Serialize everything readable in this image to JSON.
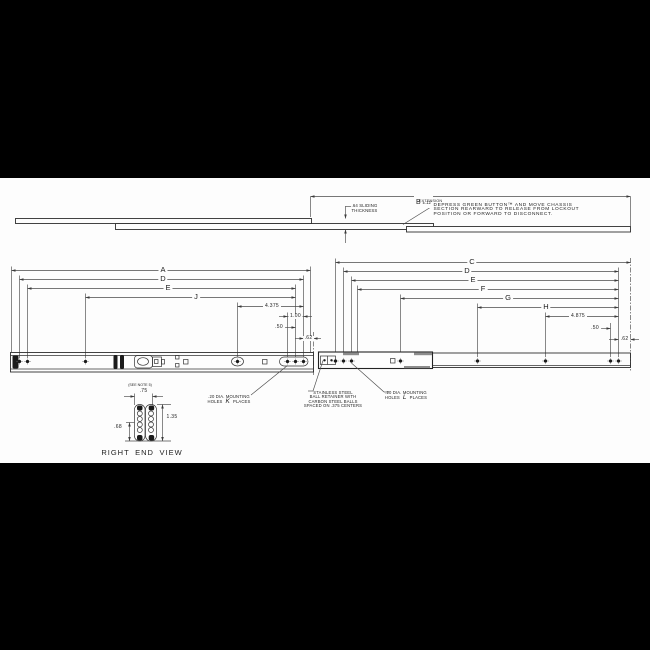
{
  "top_view": {
    "dim_b": {
      "letter": "B",
      "tolerance": "±.12",
      "sub_label": "EXTENSION"
    },
    "thickness_note": {
      "line1": ".64 SLIDING",
      "line2": "THICKNESS"
    },
    "callout": {
      "line1": "DEPRESS GREEN BUTTON™ AND MOVE CHASSIS",
      "line2": "SECTION REARWARD TO RELEASE FROM LOCKOUT",
      "line3": "POSITION OR FORWARD TO DISCONNECT."
    }
  },
  "main_view": {
    "left_dims": [
      "A",
      "D",
      "E",
      "J",
      "4.375",
      "1.00",
      ".50",
      ".62"
    ],
    "right_dims": [
      "C",
      "D",
      "E",
      "F",
      "G",
      "H",
      "4.875",
      ".50",
      ".62"
    ],
    "notes": {
      "k_note": {
        "line1": ".20 DIA. MOUNTING",
        "holes_word": "HOLES",
        "letter": "K",
        "places_word": "PLACES"
      },
      "retainer_note": {
        "line1": "STAINLESS STEEL",
        "line2": "BALL RETAINER WITH",
        "line3": "CARBON STEEL BALLS",
        "line4": "SPACED ON .375 CENTERS"
      },
      "l_note": {
        "line1": ".20 DIA. MOUNTING",
        "holes_word": "HOLES",
        "letter": "L",
        "places_word": "PLACES"
      }
    }
  },
  "end_view": {
    "see_note": "(SEE NOTE 5)",
    "dim_width": ".75",
    "dim_height": "1.35",
    "dim_half": ".68",
    "title": "RIGHT END VIEW"
  }
}
